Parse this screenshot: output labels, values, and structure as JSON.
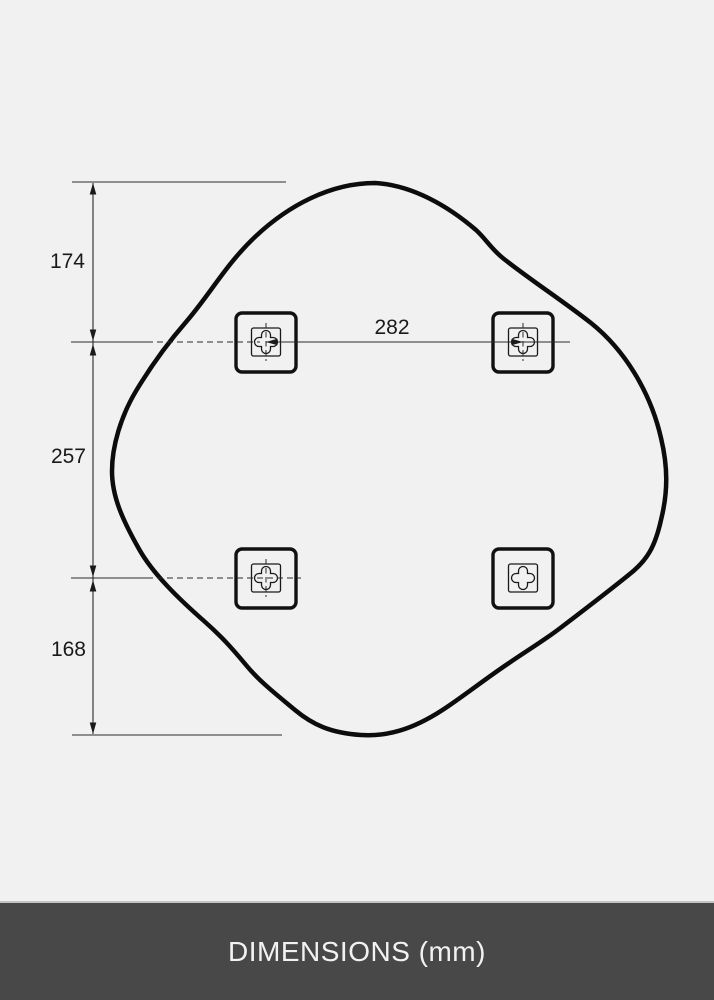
{
  "page": {
    "background_color": "#f1f1f1"
  },
  "diagram": {
    "type": "product-dimension-drawing",
    "shape": "organic-rounded-mirror-outline",
    "unit": "mm",
    "dimensions": {
      "left_top_offset": "174",
      "left_middle_span": "257",
      "left_bottom_offset": "168",
      "top_bracket_spacing": "282"
    },
    "mounting_brackets": {
      "count": 4,
      "positions": [
        "top-left",
        "top-right",
        "bottom-left",
        "bottom-right"
      ]
    },
    "line_color": "#1a1a1a",
    "outline_color": "#0c0c0c"
  },
  "footer": {
    "label": "DIMENSIONS (mm)",
    "background_color": "#484848",
    "text_color": "#f2f2f2"
  }
}
